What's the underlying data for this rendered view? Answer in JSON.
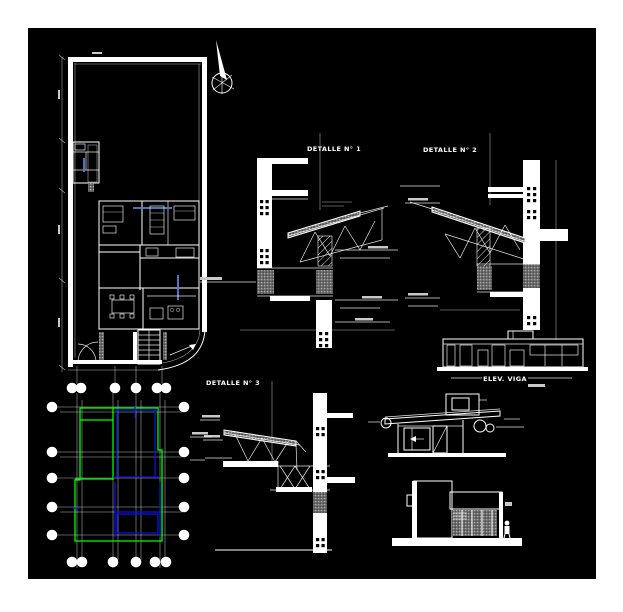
{
  "sheet": {
    "page_background": "#ffffff",
    "canvas_background": "#000000",
    "description": "architectural-cad-sheet"
  },
  "colors": {
    "page": "#ffffff",
    "canvas": "#000000",
    "line": "#ffffff",
    "green": "#00ff00",
    "blue": "#0f0fd8",
    "planblue": "#5b7fd4"
  },
  "labels": {
    "detalle1": "DETALLE N° 1",
    "detalle2": "DETALLE N° 2",
    "detalle3": "DETALLE N° 3",
    "elev_viga": "ELEV. VIGA"
  }
}
